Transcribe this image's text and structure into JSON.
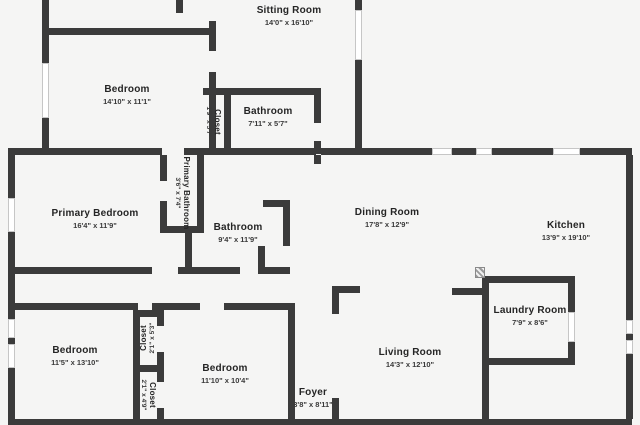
{
  "canvas": {
    "width": 640,
    "height": 425,
    "background_color": "#f5f5f4",
    "wall_color": "#3b3b3b",
    "window_fill": "#ffffff",
    "window_border": "#c6c6c6",
    "text_color": "#252525"
  },
  "rooms": [
    {
      "name": "Sitting Room",
      "dims": "14'0\" x 16'10\"",
      "x": 289,
      "y": 16,
      "rotate": 0,
      "small": false
    },
    {
      "name": "Bedroom",
      "dims": "14'10\" x 11'1\"",
      "x": 127,
      "y": 95,
      "rotate": 0,
      "small": false
    },
    {
      "name": "Closet",
      "dims": "1'9\" x 5'7\"",
      "x": 213,
      "y": 122,
      "rotate": 90,
      "small": true
    },
    {
      "name": "Bathroom",
      "dims": "7'11\" x 5'7\"",
      "x": 268,
      "y": 117,
      "rotate": 0,
      "small": false
    },
    {
      "name": "Primary Bedroom",
      "dims": "16'4\" x 11'9\"",
      "x": 95,
      "y": 219,
      "rotate": 0,
      "small": false
    },
    {
      "name": "Primary Bathroom",
      "dims": "3'6\" x 7'4\"",
      "x": 182,
      "y": 193,
      "rotate": 90,
      "small": true
    },
    {
      "name": "Bathroom",
      "dims": "9'4\" x 11'9\"",
      "x": 238,
      "y": 233,
      "rotate": 0,
      "small": false
    },
    {
      "name": "Dining Room",
      "dims": "17'8\" x 12'9\"",
      "x": 387,
      "y": 218,
      "rotate": 0,
      "small": false
    },
    {
      "name": "Kitchen",
      "dims": "13'9\" x 19'10\"",
      "x": 566,
      "y": 231,
      "rotate": 0,
      "small": false
    },
    {
      "name": "Laundry Room",
      "dims": "7'9\" x 8'6\"",
      "x": 530,
      "y": 316,
      "rotate": 0,
      "small": false
    },
    {
      "name": "Living Room",
      "dims": "14'3\" x 12'10\"",
      "x": 410,
      "y": 358,
      "rotate": 0,
      "small": false
    },
    {
      "name": "Foyer",
      "dims": "3'8\" x 8'11\"",
      "x": 313,
      "y": 398,
      "rotate": 0,
      "small": false
    },
    {
      "name": "Bedroom",
      "dims": "11'5\" x 13'10\"",
      "x": 75,
      "y": 356,
      "rotate": 0,
      "small": false
    },
    {
      "name": "Bedroom",
      "dims": "11'10\" x 10'4\"",
      "x": 225,
      "y": 374,
      "rotate": 0,
      "small": false
    },
    {
      "name": "Closet",
      "dims": "2'1\" x 5'3\"",
      "x": 148,
      "y": 338,
      "rotate": -90,
      "small": true
    },
    {
      "name": "Closet",
      "dims": "2'1\" x 4'9\"",
      "x": 148,
      "y": 395,
      "rotate": 90,
      "small": true
    }
  ],
  "walls": [
    [
      42,
      0,
      7,
      36
    ],
    [
      42,
      28,
      174,
      7
    ],
    [
      42,
      35,
      7,
      30
    ],
    [
      42,
      116,
      7,
      38
    ],
    [
      176,
      0,
      7,
      13
    ],
    [
      209,
      21,
      7,
      30
    ],
    [
      209,
      72,
      7,
      82
    ],
    [
      355,
      0,
      7,
      10
    ],
    [
      355,
      60,
      7,
      94
    ],
    [
      203,
      88,
      118,
      7
    ],
    [
      224,
      95,
      7,
      57
    ],
    [
      314,
      95,
      7,
      28
    ],
    [
      314,
      141,
      7,
      13
    ],
    [
      8,
      148,
      154,
      7
    ],
    [
      184,
      148,
      132,
      7
    ],
    [
      321,
      148,
      111,
      7
    ],
    [
      452,
      148,
      24,
      7
    ],
    [
      492,
      148,
      61,
      7
    ],
    [
      580,
      148,
      52,
      7
    ],
    [
      8,
      155,
      7,
      43
    ],
    [
      8,
      232,
      7,
      87
    ],
    [
      8,
      338,
      7,
      6
    ],
    [
      8,
      368,
      7,
      51
    ],
    [
      626,
      155,
      7,
      165
    ],
    [
      626,
      334,
      7,
      6
    ],
    [
      626,
      354,
      7,
      65
    ],
    [
      8,
      419,
      624,
      6
    ],
    [
      160,
      155,
      7,
      26
    ],
    [
      160,
      201,
      7,
      32
    ],
    [
      160,
      226,
      44,
      7
    ],
    [
      197,
      155,
      7,
      78
    ],
    [
      185,
      233,
      7,
      41
    ],
    [
      8,
      267,
      144,
      7
    ],
    [
      178,
      267,
      62,
      7
    ],
    [
      262,
      267,
      28,
      7
    ],
    [
      263,
      200,
      27,
      7
    ],
    [
      283,
      200,
      7,
      46
    ],
    [
      258,
      246,
      7,
      28
    ],
    [
      314,
      155,
      7,
      9
    ],
    [
      8,
      303,
      130,
      7
    ],
    [
      152,
      303,
      48,
      7
    ],
    [
      224,
      303,
      71,
      7
    ],
    [
      133,
      310,
      7,
      109
    ],
    [
      133,
      310,
      31,
      7
    ],
    [
      133,
      365,
      31,
      7
    ],
    [
      157,
      310,
      7,
      16
    ],
    [
      157,
      352,
      7,
      13
    ],
    [
      157,
      372,
      7,
      10
    ],
    [
      157,
      408,
      7,
      11
    ],
    [
      288,
      310,
      7,
      109
    ],
    [
      332,
      286,
      7,
      28
    ],
    [
      332,
      286,
      28,
      7
    ],
    [
      332,
      398,
      7,
      21
    ],
    [
      452,
      288,
      36,
      7
    ],
    [
      482,
      276,
      7,
      143
    ],
    [
      489,
      276,
      86,
      7
    ],
    [
      568,
      283,
      7,
      29
    ],
    [
      568,
      342,
      7,
      22
    ],
    [
      489,
      358,
      86,
      7
    ]
  ],
  "windows": [
    [
      42,
      63,
      7,
      55
    ],
    [
      355,
      10,
      7,
      50
    ],
    [
      432,
      148,
      20,
      7
    ],
    [
      476,
      148,
      16,
      7
    ],
    [
      553,
      148,
      27,
      7
    ],
    [
      8,
      198,
      7,
      34
    ],
    [
      8,
      319,
      7,
      19
    ],
    [
      8,
      344,
      7,
      24
    ],
    [
      626,
      320,
      7,
      14
    ],
    [
      626,
      340,
      7,
      14
    ],
    [
      568,
      312,
      7,
      30
    ]
  ],
  "door_markers": [
    [
      475,
      267,
      10,
      11
    ]
  ]
}
